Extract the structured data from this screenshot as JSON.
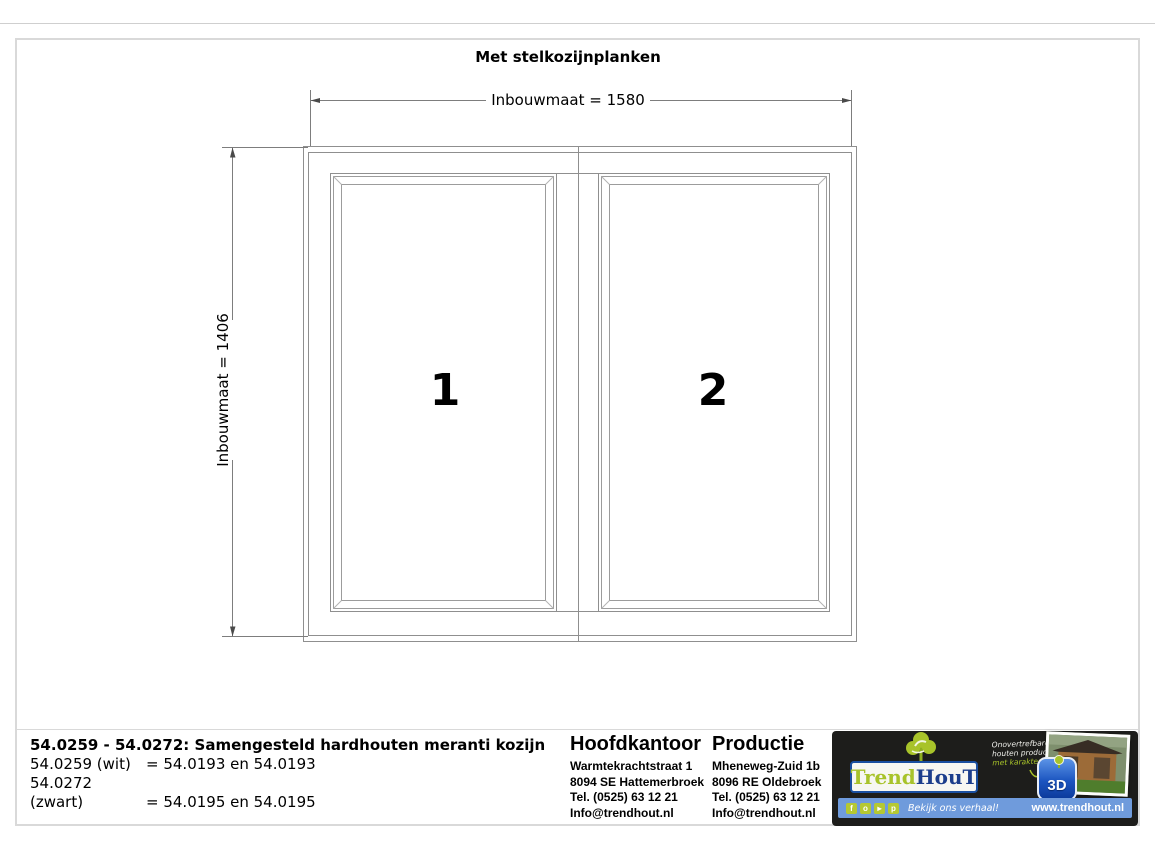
{
  "title": "Met stelkozijnplanken",
  "drawing": {
    "width_dim": "Inbouwmaat = 1580",
    "height_dim": "Inbouwmaat = 1406",
    "panel1": "1",
    "panel2": "2"
  },
  "footer": {
    "product": {
      "title": "54.0259 - 54.0272: Samengesteld hardhouten meranti kozijn",
      "rows": [
        {
          "code": "54.0259 (wit)",
          "value": "= 54.0193 en 54.0193"
        },
        {
          "code": "54.0272 (zwart)",
          "value": "= 54.0195 en 54.0195"
        }
      ]
    },
    "hoofdkantoor": {
      "heading": "Hoofdkantoor",
      "lines": [
        "Warmtekrachtstraat 1",
        "8094 SE Hattemerbroek",
        "Tel. (0525) 63 12 21",
        "Info@trendhout.nl"
      ]
    },
    "productie": {
      "heading": "Productie",
      "lines": [
        "Mheneweg-Zuid 1b",
        "8096 RE Oldebroek",
        "Tel. (0525) 63 12 21",
        "Info@trendhout.nl"
      ]
    },
    "brand": {
      "logo": {
        "part1": "Trend",
        "part2": "HouT"
      },
      "tagline": [
        "Onovertrefbare",
        "houten producten",
        "met karakter"
      ],
      "badge": "3D",
      "cta": "Bekijk ons verhaal!",
      "website": "www.trendhout.nl",
      "social": [
        {
          "name": "facebook",
          "glyph": "f"
        },
        {
          "name": "instagram",
          "glyph": "o"
        },
        {
          "name": "youtube",
          "glyph": "▸"
        },
        {
          "name": "pinterest",
          "glyph": "p"
        }
      ],
      "colors": {
        "green": "#a8c32a",
        "navy": "#1c3e8c",
        "bar_blue": "#6f9bdc",
        "panel_black": "#1d1d1b"
      }
    }
  }
}
